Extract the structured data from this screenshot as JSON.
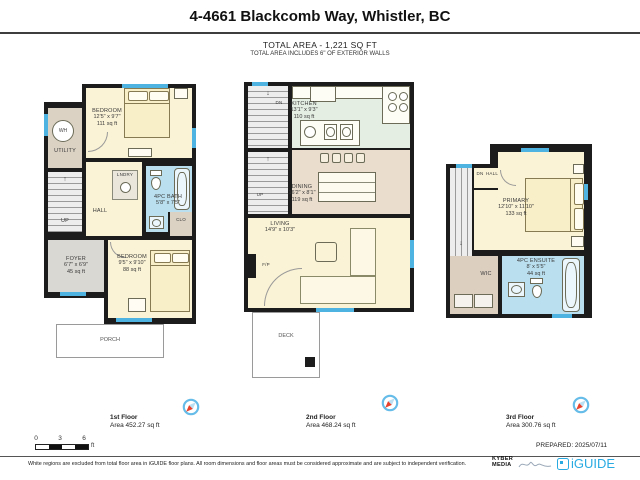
{
  "header": {
    "title": "4-4661 Blackcomb Way, Whistler, BC",
    "total_area": "TOTAL AREA - 1,221 SQ FT",
    "total_area_note": "TOTAL AREA INCLUDES 6\" OF EXTERIOR WALLS"
  },
  "floors": [
    {
      "label": "1st Floor",
      "area": "Area 452.27 sq ft",
      "rooms": {
        "bedroom_a": {
          "name": "BEDROOM",
          "dims": "12'5\" x 9'7\"",
          "area": "111 sq ft"
        },
        "utility": {
          "name": "UTILITY"
        },
        "wh": {
          "name": "WH"
        },
        "lndry": {
          "name": "LNDRY"
        },
        "hall": {
          "name": "HALL"
        },
        "up": {
          "name": "UP"
        },
        "bath": {
          "name": "4PC BATH",
          "dims": "5'8\" x 7'5\""
        },
        "clo": {
          "name": "CLO"
        },
        "foyer": {
          "name": "FOYER",
          "dims": "6'7\" x 6'9\"",
          "area": "45 sq ft"
        },
        "bedroom_b": {
          "name": "BEDROOM",
          "dims": "9'5\" x 9'10\"",
          "area": "88 sq ft"
        },
        "porch": {
          "name": "PORCH"
        }
      }
    },
    {
      "label": "2nd Floor",
      "area": "Area 468.24 sq ft",
      "rooms": {
        "kitchen": {
          "name": "KITCHEN",
          "dims": "13'1\" x 9'3\"",
          "area": "110 sq ft"
        },
        "dn": {
          "name": "DN"
        },
        "up": {
          "name": "UP"
        },
        "dining": {
          "name": "DINING",
          "dims": "16'2\" x 8'1\"",
          "area": "119 sq ft"
        },
        "living": {
          "name": "LIVING",
          "dims": "14'9\" x 10'3\""
        },
        "fp": {
          "name": "F/P"
        },
        "deck": {
          "name": "DECK"
        }
      }
    },
    {
      "label": "3rd Floor",
      "area": "Area 300.76 sq ft",
      "rooms": {
        "dn": {
          "name": "DN"
        },
        "hall": {
          "name": "HALL"
        },
        "primary": {
          "name": "PRIMARY",
          "dims": "12'10\" x 11'10\"",
          "area": "133 sq ft"
        },
        "wic": {
          "name": "WIC"
        },
        "ensuite": {
          "name": "4PC ENSUITE",
          "dims": "8' x 5'5\"",
          "area": "44 sq ft"
        }
      }
    }
  ],
  "scale_bar": {
    "tick0": "0",
    "tick3": "3",
    "tick6": "6",
    "unit": "ft"
  },
  "footer": {
    "prepared": "PREPARED: 2025/07/11",
    "disclaimer": "White regions are excluded from total floor area in iGUIDE floor plans. All room dimensions and floor areas must be considered approximate and are subject to independent verification.",
    "kyber_line1": "KYBER",
    "kyber_line2": "MEDIA",
    "iguide": "iGUIDE"
  },
  "icons": {
    "up_arrow": "↑",
    "down_arrow": "↓"
  },
  "colors": {
    "wall": "#1C1C1C",
    "floor_cream": "#FBF3D6",
    "bath_blue": "#BAE0F0",
    "kitchen_green": "#E4EEE3",
    "dining_tan": "#EADDCD",
    "utility_taupe": "#DBD2C3",
    "window_blue": "#4FB3E2",
    "iguide_blue": "#29ABE2",
    "compass_red": "#E8402A"
  }
}
